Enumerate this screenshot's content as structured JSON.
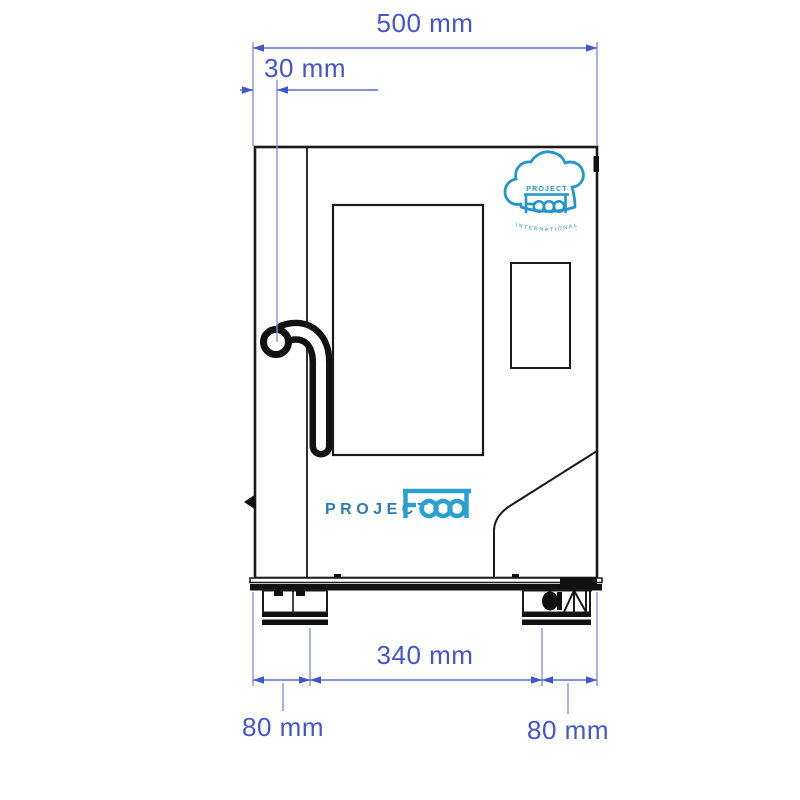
{
  "page": {
    "background": "#ffffff",
    "type": "technical dimension drawing of combi oven (side view)"
  },
  "dimensions": {
    "total_width": "500 mm",
    "handle_offset": "30 mm",
    "feet_spacing": "340 mm",
    "left_foot_offset": "80 mm",
    "right_foot_offset": "80 mm"
  },
  "branding": {
    "logo_badge": {
      "project": "PROJECT",
      "food": "Food",
      "international": "INTERNATIONAL"
    },
    "door_wordmark": {
      "project": "PROJECT",
      "food": "Food"
    }
  },
  "icons": {
    "chef-hat-logo": "chef hat cloud outline containing PROJECT Food wordmark"
  },
  "colors": {
    "dimension_blue": "#4155cf",
    "extension_blue": "#8392e2",
    "drawing_line": "#1a1a1a",
    "logo_blue": "#2196ca",
    "wordmark_project_blue": "#2f7ab8",
    "wordmark_food_blue": "#2aa0d2"
  }
}
